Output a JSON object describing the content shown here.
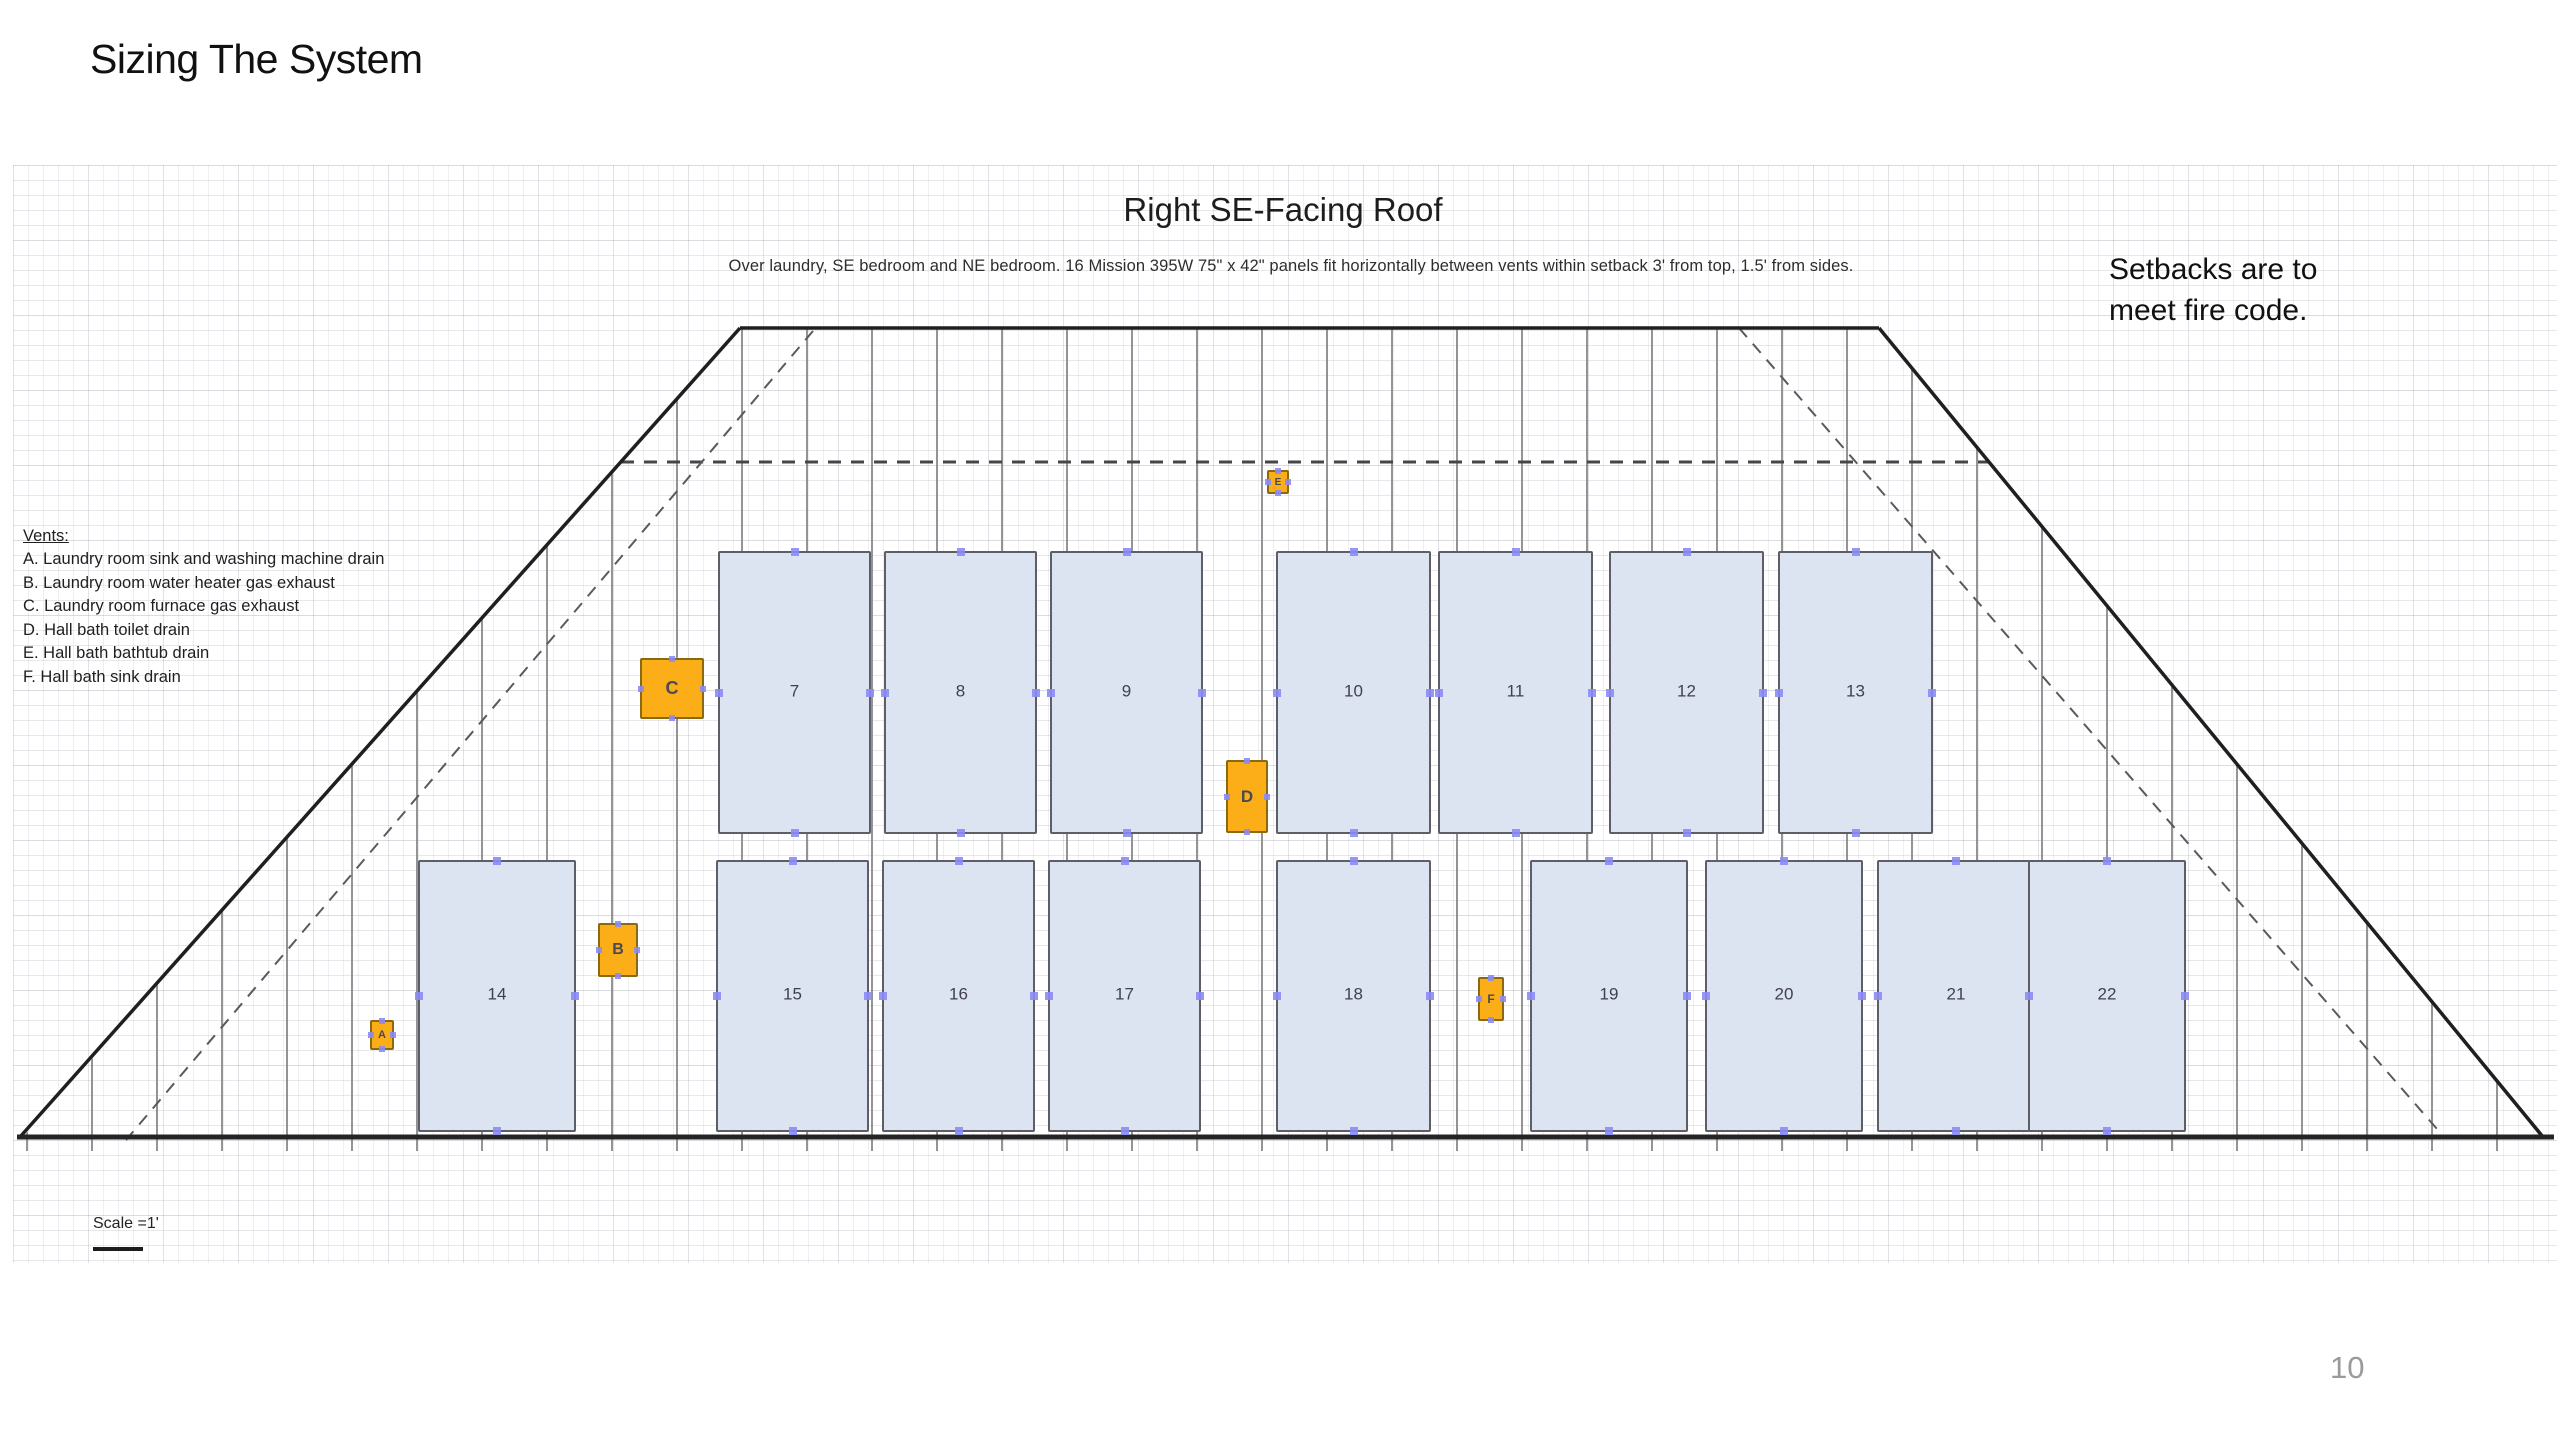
{
  "slide": {
    "title": "Sizing The System",
    "page_number": "10"
  },
  "diagram": {
    "title": "Right SE-Facing Roof",
    "subtitle": "Over laundry, SE bedroom and NE bedroom.  16 Mission 395W  75\" x 42\" panels fit horizontally between vents within setback 3' from top, 1.5' from sides.",
    "setback_note": "Setbacks are to\nmeet fire code.",
    "scale_label": "Scale =1'",
    "vents_legend": {
      "heading": "Vents:",
      "items": [
        "A. Laundry room sink and washing machine drain",
        "B. Laundry room water heater gas exhaust",
        "C. Laundry room furnace gas exhaust",
        "D. Hall bath toilet drain",
        "E. Hall bath bathtub drain",
        "F. Hall bath sink drain"
      ]
    },
    "panels": [
      {
        "num": "7",
        "x": 705,
        "y": 386,
        "w": 153,
        "h": 283
      },
      {
        "num": "8",
        "x": 871,
        "y": 386,
        "w": 153,
        "h": 283
      },
      {
        "num": "9",
        "x": 1037,
        "y": 386,
        "w": 153,
        "h": 283
      },
      {
        "num": "10",
        "x": 1263,
        "y": 386,
        "w": 155,
        "h": 283
      },
      {
        "num": "11",
        "x": 1425,
        "y": 386,
        "w": 155,
        "h": 283
      },
      {
        "num": "12",
        "x": 1596,
        "y": 386,
        "w": 155,
        "h": 283
      },
      {
        "num": "13",
        "x": 1765,
        "y": 386,
        "w": 155,
        "h": 283
      },
      {
        "num": "14",
        "x": 405,
        "y": 695,
        "w": 158,
        "h": 272
      },
      {
        "num": "15",
        "x": 703,
        "y": 695,
        "w": 153,
        "h": 272
      },
      {
        "num": "16",
        "x": 869,
        "y": 695,
        "w": 153,
        "h": 272
      },
      {
        "num": "17",
        "x": 1035,
        "y": 695,
        "w": 153,
        "h": 272
      },
      {
        "num": "18",
        "x": 1263,
        "y": 695,
        "w": 155,
        "h": 272
      },
      {
        "num": "19",
        "x": 1517,
        "y": 695,
        "w": 158,
        "h": 272
      },
      {
        "num": "20",
        "x": 1692,
        "y": 695,
        "w": 158,
        "h": 272
      },
      {
        "num": "21",
        "x": 1864,
        "y": 695,
        "w": 158,
        "h": 272
      },
      {
        "num": "22",
        "x": 2015,
        "y": 695,
        "w": 158,
        "h": 272
      }
    ],
    "vents": [
      {
        "id": "A",
        "x": 357,
        "y": 855,
        "w": 24,
        "h": 30,
        "fs": 11
      },
      {
        "id": "B",
        "x": 585,
        "y": 758,
        "w": 40,
        "h": 54,
        "fs": 16
      },
      {
        "id": "C",
        "x": 627,
        "y": 493,
        "w": 64,
        "h": 61,
        "fs": 18
      },
      {
        "id": "D",
        "x": 1213,
        "y": 595,
        "w": 42,
        "h": 73,
        "fs": 17
      },
      {
        "id": "E",
        "x": 1254,
        "y": 305,
        "w": 22,
        "h": 24,
        "fs": 10
      },
      {
        "id": "F",
        "x": 1465,
        "y": 812,
        "w": 26,
        "h": 44,
        "fs": 12
      }
    ],
    "colors": {
      "panel_fill": "#dce3f1",
      "panel_border": "#5e5e66",
      "vent_fill": "#fbae17",
      "vent_border": "#8a6a10",
      "handle": "#8b8bf5",
      "roof_outline": "#1f1f1f",
      "dashed_line": "#555555"
    }
  }
}
